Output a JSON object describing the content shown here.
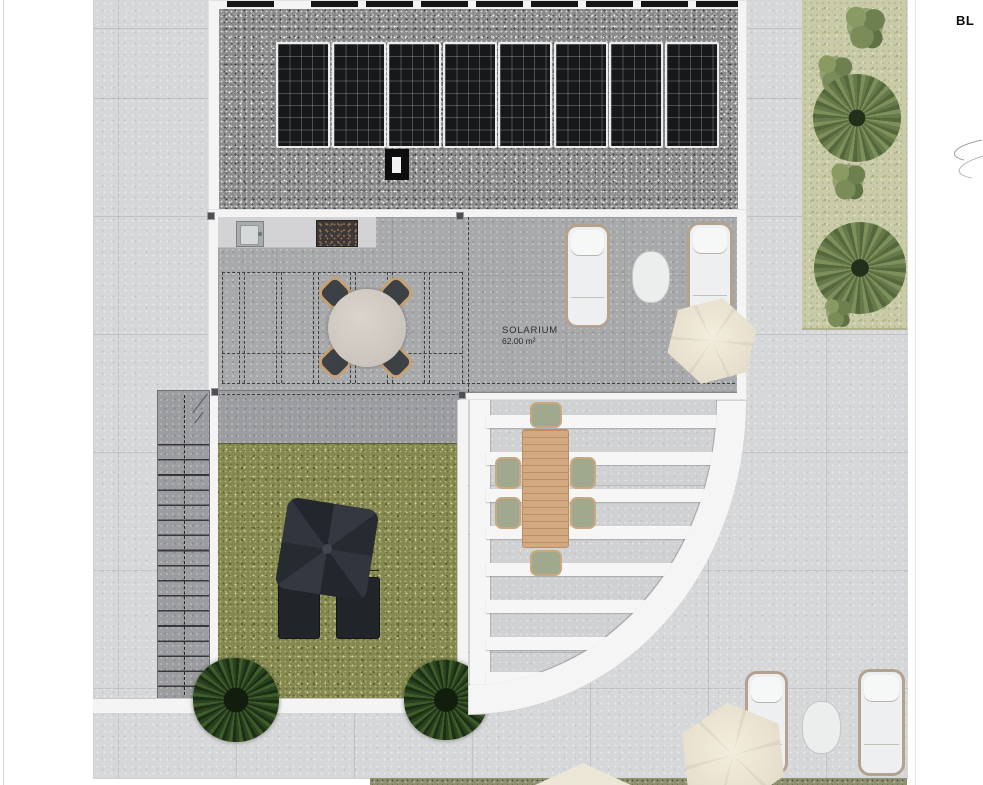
{
  "plan": {
    "solarium_label": "SOLARIUM",
    "solarium_area": "62.00 m²",
    "block_label": "BL"
  },
  "colors": {
    "paving": "#d6d7d9",
    "paving_dark": "#9c9da0",
    "concrete": "#a8a9ab",
    "gravel": "#8b8b8b",
    "lawn": "#85894f",
    "planting": "#c9cba8",
    "hedge": "#8e9070",
    "white_structure": "#f4f4f5",
    "solar_panel": "#17181a",
    "umbrella_cream": "#e8e1cf",
    "umbrella_black": "#2b2e33",
    "wood_table": "#d2a981",
    "lounger_frame": "#b3a28d"
  },
  "structures": {
    "solar_panels_main_count": 8,
    "solar_panel_stub_offsets": [
      18,
      102,
      157,
      212,
      267,
      322,
      377,
      432,
      487
    ],
    "pergola_louver_offsets": [
      15,
      52,
      89,
      126,
      163,
      200,
      237,
      272
    ],
    "kitchen_grid_centers": [
      24,
      61,
      98,
      135,
      172,
      209
    ],
    "stair_tread_count": 17
  }
}
